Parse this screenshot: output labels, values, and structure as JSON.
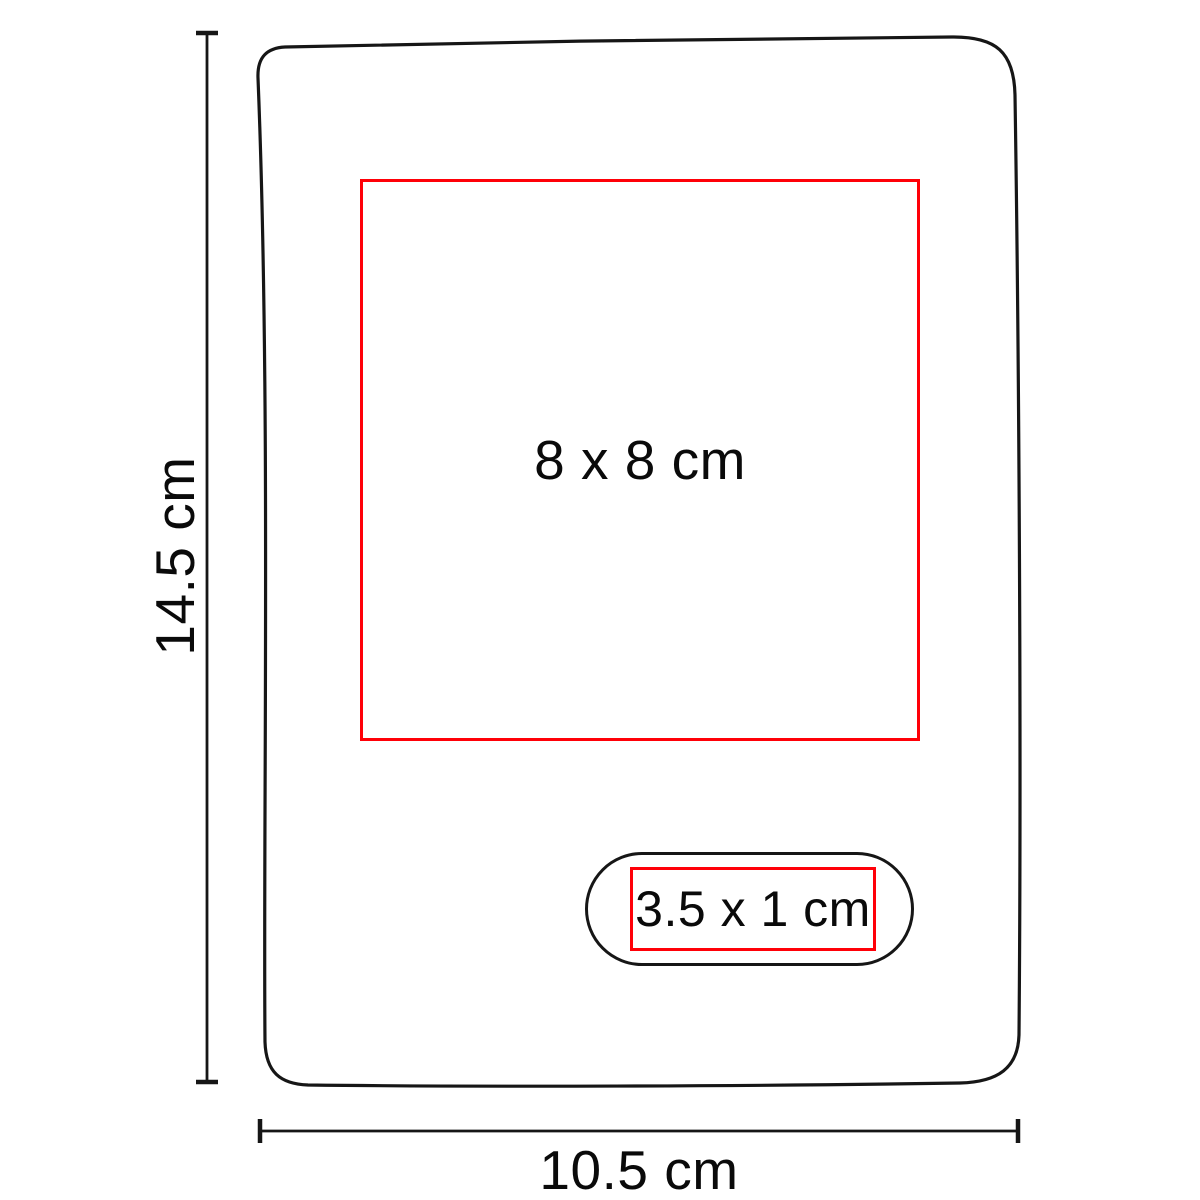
{
  "diagram": {
    "title": "product-dimension-diagram",
    "height_dimension": {
      "label": "14.5 cm"
    },
    "width_dimension": {
      "label": "10.5 cm"
    },
    "main_print_area": {
      "label": "8 x 8 cm"
    },
    "small_print_area": {
      "label": "3.5 x 1 cm"
    },
    "colors": {
      "outline": "#161616",
      "dimension": "#161616",
      "print-area": "#ff0008",
      "text": "#0a0a0a",
      "background": "#ffffff"
    }
  }
}
